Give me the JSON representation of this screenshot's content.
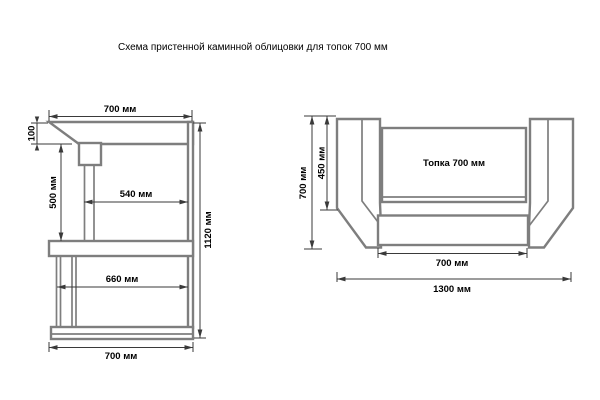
{
  "title": "Схема пристенной каминной облицовки для топок 700 мм",
  "side_view": {
    "dims": {
      "top_width": "700 мм",
      "hood_drop": "100",
      "portal_height": "500 мм",
      "portal_width": "540 мм",
      "plinth_inner_width": "660 мм",
      "total_height": "1120 мм",
      "bottom_width": "700 мм"
    }
  },
  "plan_view": {
    "firebox_label": "Топка 700 мм",
    "dims": {
      "total_depth": "700 мм",
      "inner_depth": "450 мм",
      "opening_width": "700 мм",
      "total_width": "1300 мм"
    }
  },
  "colors": {
    "outline": "#7e7e7e",
    "dimension_line": "#3a3a3a",
    "text": "#000000",
    "background": "#ffffff"
  }
}
